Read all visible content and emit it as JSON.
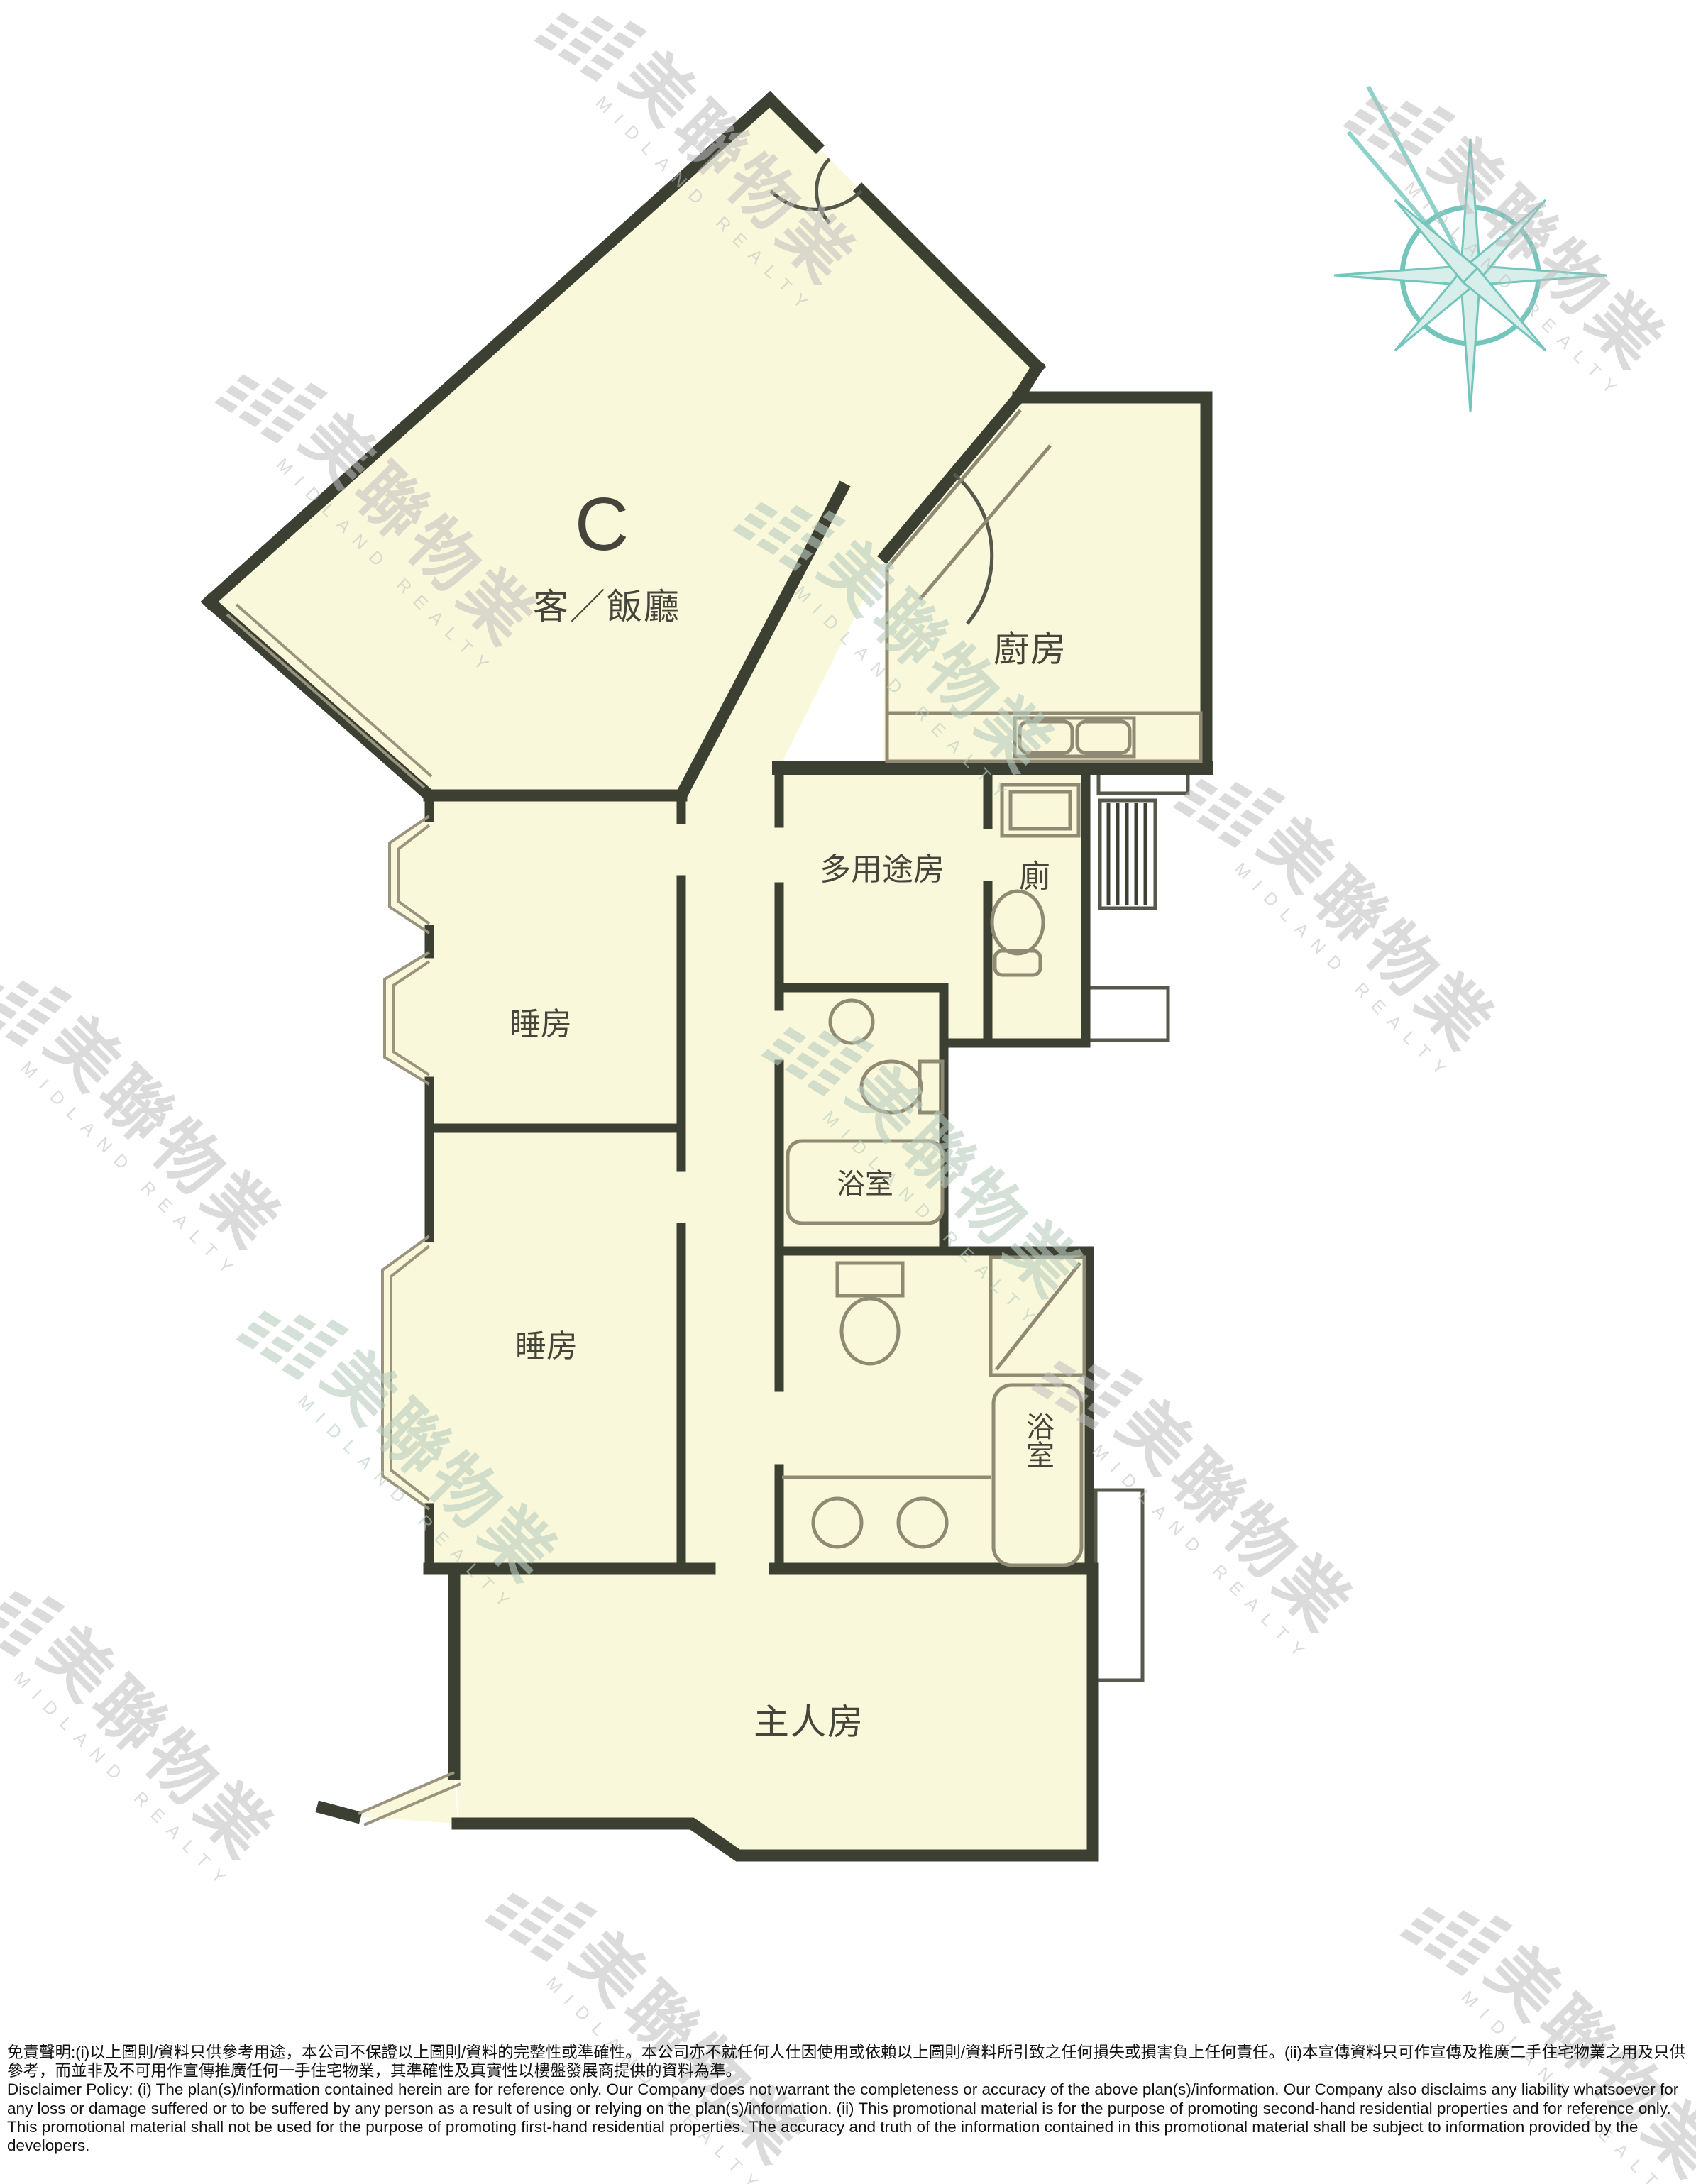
{
  "floor_plan": {
    "unit_label": "C",
    "rooms": {
      "living_dining": "客／飯廳",
      "kitchen": "廚房",
      "multipurpose_room": "多用途房",
      "toilet": "廁",
      "bedroom_1": "睡房",
      "bedroom_2": "睡房",
      "bathroom_1": "浴室",
      "master_bathroom": "浴室",
      "master_bedroom": "主人房"
    }
  },
  "watermark": {
    "cjk": "美聯物業",
    "latin": "MIDLAND REALTY"
  },
  "palette": {
    "room_fill": "#faf8da",
    "wall": "#3c4033",
    "fixture_line": "#8f8a74",
    "compass_teal": "#74c5bc",
    "watermark_gray": "#bfbfbf"
  },
  "disclaimer": {
    "zh": "免責聲明:(i)以上圖則/資料只供參考用途，本公司不保證以上圖則/資料的完整性或準確性。本公司亦不就任何人仕因使用或依賴以上圖則/資料所引致之任何損失或損害負上任何責任。(ii)本宣傳資料只可作宣傳及推廣二手住宅物業之用及只供參考，而並非及不可用作宣傳推廣任何一手住宅物業，其準確性及真實性以樓盤發展商提供的資料為準。",
    "en": "Disclaimer Policy: (i) The plan(s)/information contained herein are for reference only. Our Company does not warrant the completeness or accuracy of the above plan(s)/information. Our Company also disclaims any liability whatsoever for any loss or damage suffered or to be suffered by any person as a result of using or relying on the plan(s)/information. (ii) This promotional material is for the purpose of promoting second-hand residential properties and for reference only. This promotional material shall not be used for the purpose of promoting first-hand residential properties. The accuracy and truth of the information contained in this promotional material shall be subject to information provided by the developers."
  }
}
